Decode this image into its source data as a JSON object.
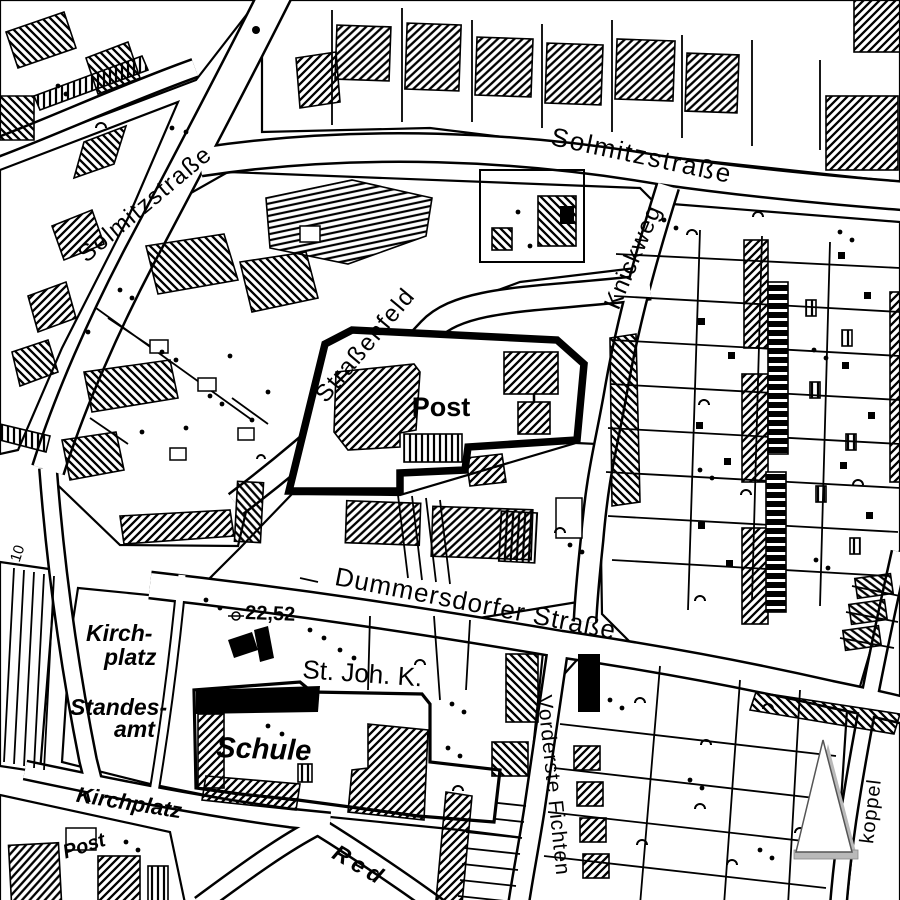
{
  "map": {
    "streets": {
      "solmitzstrasse_left": "Solmitzstraße",
      "solmitzstrasse_top": "Solmitzstraße",
      "strassenfeld": "Straßenfeld",
      "knickweg": "Knickweg",
      "dummersdorfer_strasse": "Dummersdorfer Straße",
      "vorderste_fichten": "Vorderste Fichten",
      "kirchplatz": "Kirchplatz",
      "red": "Red",
      "koppel": "koppel"
    },
    "places": {
      "post": "Post",
      "post_small": "Post",
      "kirchplatz_line1": "Kirch-",
      "kirchplatz_line2": "platz",
      "standesamt_line1": "Standes-",
      "standesamt_line2": "amt",
      "st_joh_k": "St. Joh. K.",
      "schule": "Schule",
      "elevation_point": "22,52",
      "house_number": "10"
    },
    "icons": {
      "north_arrow": "north-arrow"
    },
    "colors": {
      "ink": "#000000",
      "paper": "#ffffff",
      "arrow_shadow": "#b9b9b9"
    }
  }
}
